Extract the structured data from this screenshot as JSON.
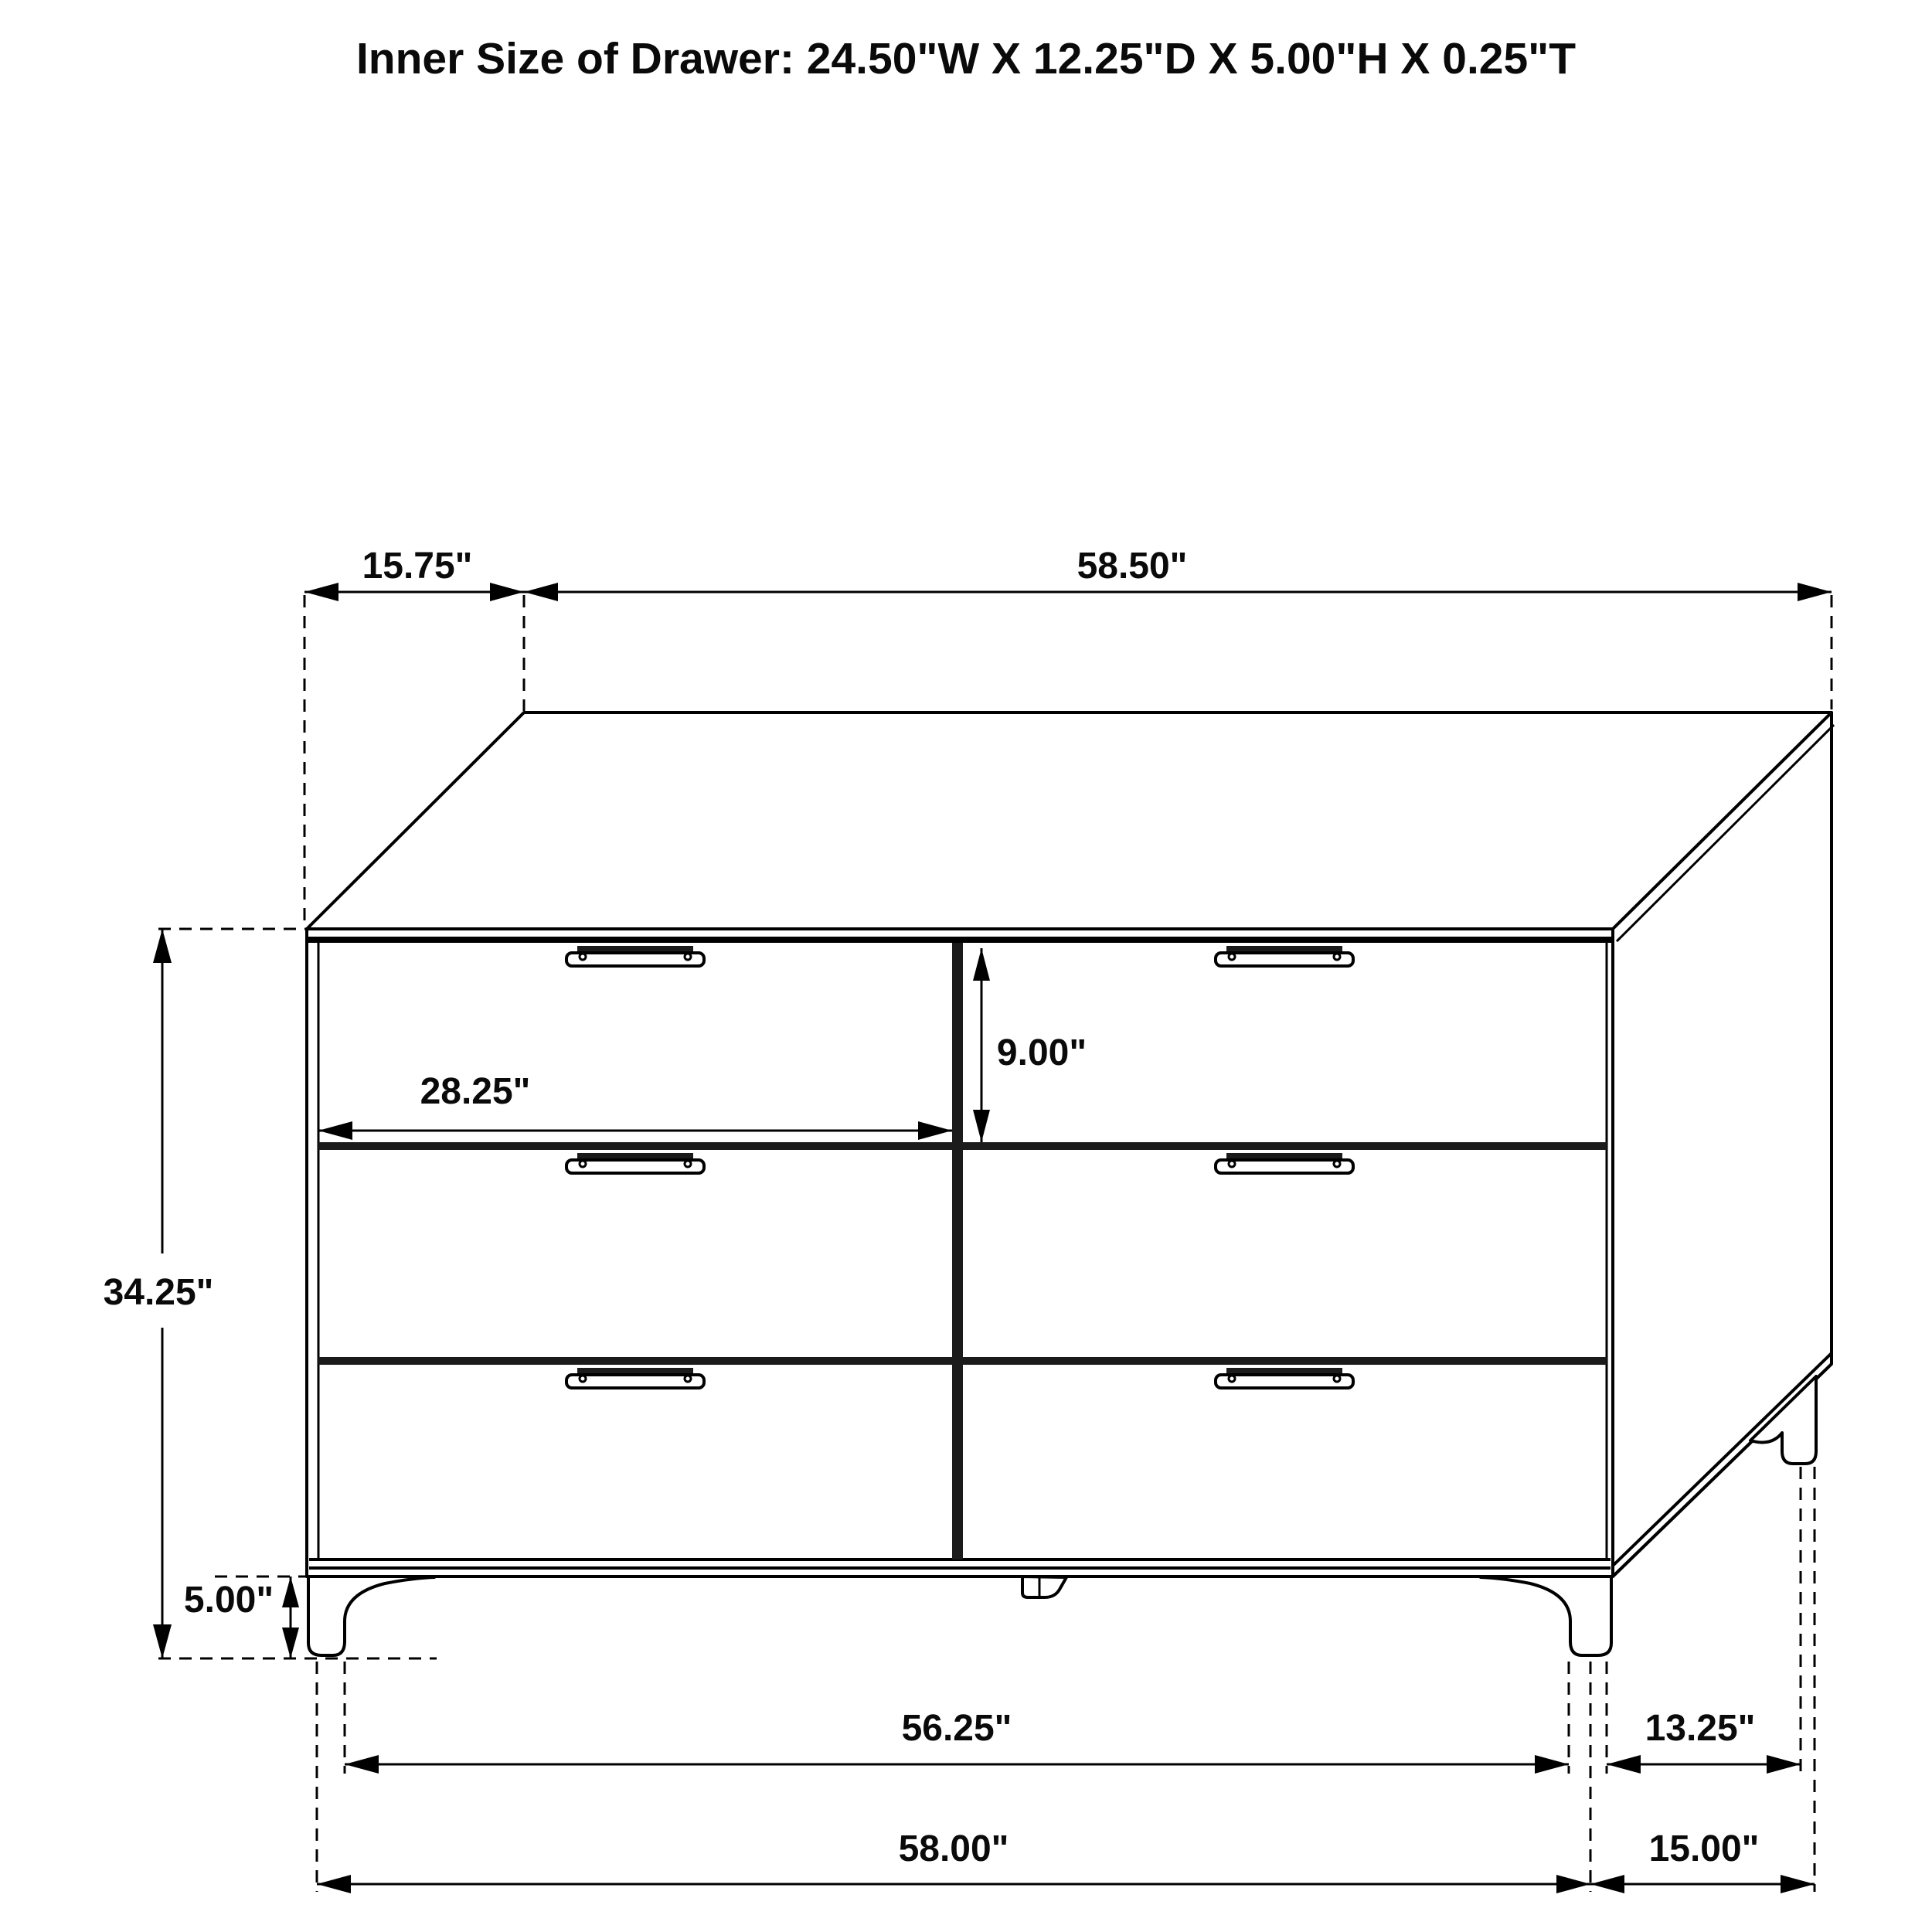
{
  "title": "Inner Size of Drawer: 24.50\"W X 12.25\"D X 5.00\"H X 0.25\"T",
  "dimensions": {
    "top_depth": "15.75\"",
    "top_width": "58.50\"",
    "overall_height": "34.25\"",
    "leg_height": "5.00\"",
    "drawer_width": "28.25\"",
    "drawer_height": "9.00\"",
    "front_feet_span": "56.25\"",
    "side_feet_span": "13.25\"",
    "base_width": "58.00\"",
    "base_depth": "15.00\""
  },
  "colors": {
    "line": "#000000",
    "background": "#ffffff"
  }
}
